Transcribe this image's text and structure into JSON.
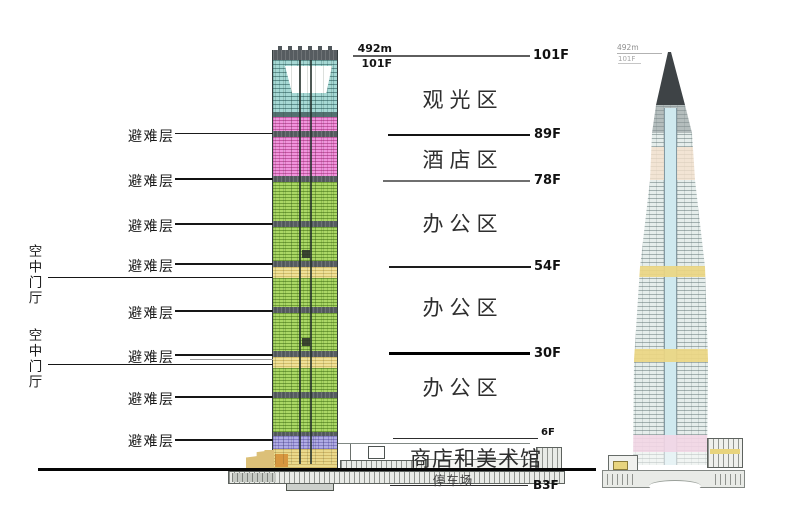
{
  "dimension_labels": {
    "height": "492m",
    "top_floor": "101F"
  },
  "left_annotations": {
    "refuge_floor": "避难层",
    "sky_lobby": "空中门厅"
  },
  "zones": {
    "observation": "观光区",
    "hotel": "酒店区",
    "office": "办公区",
    "shops_gallery": "商店和美术馆",
    "parking": "停车场"
  },
  "floor_marks": {
    "f101": "101F",
    "f89": "89F",
    "f78": "78F",
    "f54": "54F",
    "f30": "30F",
    "f6": "6F",
    "b3": "B3F"
  },
  "right_tower_labels": {
    "height": "492m",
    "top_floor": "101F"
  },
  "colors": {
    "observation_teal": "#a6d8d4",
    "hotel_pink": "#f094dc",
    "office_green": "#abd765",
    "sky_lobby_yellow": "#efe097",
    "shops_lavender": "#b0abe4",
    "podium_tan": "#ead98b",
    "refuge_band": "#565c60",
    "ground": "#050505"
  }
}
